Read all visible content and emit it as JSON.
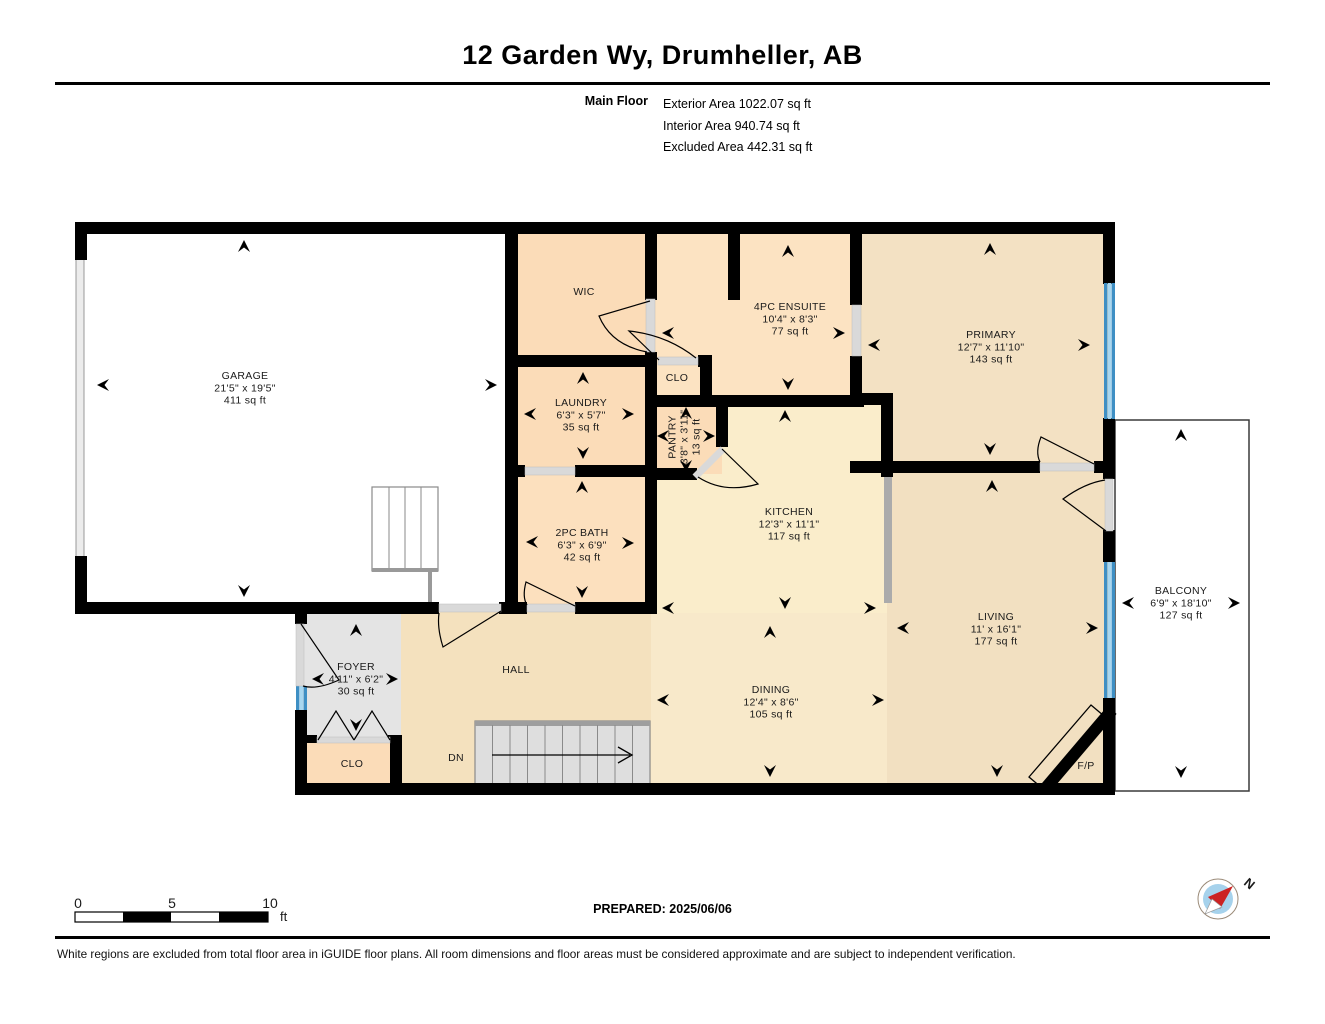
{
  "header": {
    "title": "12 Garden Wy, Drumheller, AB",
    "floor_label": "Main Floor",
    "stats": [
      "Exterior Area 1022.07 sq ft",
      "Interior Area 940.74 sq ft",
      "Excluded Area 442.31 sq ft"
    ]
  },
  "footer": {
    "prepared": "PREPARED: 2025/06/06",
    "disclaimer": "White regions are excluded from total floor area in iGUIDE floor plans. All room dimensions and floor areas must be considered approximate and are subject to independent verification."
  },
  "plan": {
    "colors": {
      "wall": "#000000",
      "sill": "#D9D9D9",
      "counter": "#ABABAB",
      "window_dark": "#3E8FC4",
      "window_light": "#A8D7F0",
      "stair_fill": "#DEDEDE",
      "stair_edge": "#8a8a8a",
      "label": "#1A1A1A"
    },
    "fills": [
      {
        "name": "garage",
        "rect": [
          81,
          228,
          430,
          380
        ],
        "color": "#FFFFFF"
      },
      {
        "name": "ensuite-area",
        "rect": [
          651,
          228,
          205,
          173
        ],
        "color": "#FCE3C2"
      },
      {
        "name": "primary",
        "rect": [
          856,
          228,
          253,
          239
        ],
        "color": "#F3E1C3"
      },
      {
        "name": "kitchen",
        "rect": [
          651,
          401,
          236,
          212
        ],
        "color": "#FAEDCB"
      },
      {
        "name": "dining",
        "rect": [
          651,
          613,
          239,
          176
        ],
        "color": "#F8E9CA"
      },
      {
        "name": "living",
        "rect": [
          887,
          467,
          222,
          322
        ],
        "color": "#F2E0C1"
      },
      {
        "name": "hall",
        "rect": [
          401,
          608,
          250,
          181
        ],
        "color": "#F4E1BE"
      },
      {
        "name": "foyer",
        "rect": [
          301,
          608,
          100,
          181
        ],
        "color": "#E4E4E4"
      },
      {
        "name": "wic",
        "rect": [
          511,
          228,
          140,
          133
        ],
        "color": "#FBDCB8"
      },
      {
        "name": "laundry",
        "rect": [
          511,
          361,
          140,
          110
        ],
        "color": "#FBDCB8"
      },
      {
        "name": "pantry",
        "rect": [
          651,
          401,
          71,
          73
        ],
        "color": "#FBDCB8"
      },
      {
        "name": "bath",
        "rect": [
          511,
          471,
          140,
          137
        ],
        "color": "#FCE0BE"
      },
      {
        "name": "clo-lower",
        "rect": [
          305,
          737,
          88,
          52
        ],
        "color": "#FBDCB8"
      }
    ],
    "balcony_rect": [
      1115,
      420,
      134,
      371
    ],
    "walls": [
      [
        75,
        222,
        1040,
        12
      ],
      [
        75,
        222,
        12,
        38
      ],
      [
        75,
        556,
        12,
        58
      ],
      [
        75,
        602,
        364,
        12
      ],
      [
        499,
        602,
        28,
        12
      ],
      [
        575,
        602,
        82,
        12
      ],
      [
        505,
        222,
        13,
        392
      ],
      [
        645,
        222,
        12,
        78
      ],
      [
        645,
        352,
        12,
        262
      ],
      [
        505,
        355,
        152,
        12
      ],
      [
        698,
        355,
        14,
        12
      ],
      [
        700,
        355,
        12,
        52
      ],
      [
        728,
        222,
        12,
        78
      ],
      [
        645,
        395,
        219,
        12
      ],
      [
        505,
        465,
        20,
        12
      ],
      [
        575,
        465,
        82,
        12
      ],
      [
        716,
        395,
        12,
        52
      ],
      [
        645,
        468,
        52,
        12
      ],
      [
        850,
        222,
        12,
        83
      ],
      [
        850,
        356,
        12,
        49
      ],
      [
        850,
        393,
        43,
        12
      ],
      [
        881,
        393,
        12,
        84
      ],
      [
        850,
        461,
        190,
        12
      ],
      [
        1094,
        461,
        21,
        12
      ],
      [
        1103,
        222,
        12,
        62
      ],
      [
        1103,
        418,
        12,
        61
      ],
      [
        1103,
        530,
        12,
        32
      ],
      [
        1103,
        698,
        12,
        97
      ],
      [
        295,
        602,
        12,
        22
      ],
      [
        295,
        710,
        12,
        85
      ],
      [
        295,
        783,
        820,
        12
      ],
      [
        307,
        735,
        10,
        8
      ],
      [
        388,
        735,
        14,
        8
      ],
      [
        390,
        735,
        12,
        60
      ]
    ],
    "garage_door": [
      76,
      258,
      8,
      300
    ],
    "counter": [
      884,
      477,
      8,
      126
    ],
    "windows": [
      {
        "name": "primary-window",
        "x": 1104,
        "y": 283,
        "len": 136
      },
      {
        "name": "living-window",
        "x": 1104,
        "y": 562,
        "len": 136
      },
      {
        "name": "foyer-window",
        "x": 296,
        "y": 686,
        "len": 24
      }
    ],
    "sills": [
      [
        439,
        604,
        62,
        8
      ],
      [
        527,
        604,
        48,
        8
      ],
      [
        525,
        467,
        50,
        8
      ],
      [
        646,
        299,
        9,
        53
      ],
      [
        658,
        357,
        40,
        8
      ],
      [
        852,
        305,
        9,
        51
      ],
      [
        1040,
        463,
        54,
        8
      ],
      [
        1105,
        479,
        8,
        52
      ],
      [
        317,
        737,
        73,
        6
      ],
      [
        296,
        624,
        8,
        62
      ]
    ],
    "diag_sill": [
      695,
      477,
      723,
      449
    ],
    "doors": [
      "M301,624 L339,680 Q317,690 303,686",
      "M501,611 L443,647 Q437,628 439,613",
      "M575,606 L526,582 Q522,597 527,605",
      "M650,301 L599,316 Q611,345 647,352",
      "M659,360 L629,331 Q667,335 696,358",
      "M722,449 L758,484 Q724,494 698,477",
      "M1094,464 L1041,437 Q1035,452 1040,462",
      "M1106,531 L1063,499 Q1085,483 1105,480"
    ],
    "bifolds": [
      [
        [
          318,
          740
        ],
        [
          336,
          711
        ],
        [
          354,
          740
        ]
      ],
      [
        [
          354,
          740
        ],
        [
          372,
          711
        ],
        [
          390,
          740
        ]
      ]
    ],
    "stairs_dn": {
      "rect": [
        475,
        721,
        175,
        64
      ],
      "treads": 9,
      "arrow_y": 755
    },
    "garage_stairs": {
      "rect": [
        372,
        487,
        66,
        84
      ],
      "treads": [
        389,
        405,
        421
      ],
      "rail_y": 570,
      "rail_x": 430,
      "rail_y2": 602
    },
    "fireplace": {
      "band": [
        1044,
        790,
        1112,
        710
      ],
      "outline": [
        [
          1029,
          777
        ],
        [
          1091,
          705
        ],
        [
          1104,
          716
        ],
        [
          1042,
          788
        ]
      ]
    },
    "arrows": [
      [
        244,
        240,
        "up"
      ],
      [
        244,
        597,
        "down"
      ],
      [
        97,
        385,
        "left"
      ],
      [
        497,
        385,
        "right"
      ],
      [
        583,
        372,
        "up"
      ],
      [
        583,
        459,
        "down"
      ],
      [
        524,
        414,
        "left"
      ],
      [
        634,
        414,
        "right"
      ],
      [
        788,
        245,
        "up"
      ],
      [
        788,
        390,
        "down"
      ],
      [
        662,
        333,
        "left"
      ],
      [
        845,
        333,
        "right"
      ],
      [
        990,
        243,
        "up"
      ],
      [
        990,
        455,
        "down"
      ],
      [
        868,
        345,
        "left"
      ],
      [
        1090,
        345,
        "right"
      ],
      [
        686,
        407,
        "up"
      ],
      [
        686,
        472,
        "down"
      ],
      [
        657,
        436,
        "left"
      ],
      [
        715,
        436,
        "right"
      ],
      [
        785,
        410,
        "up"
      ],
      [
        785,
        609,
        "down"
      ],
      [
        662,
        608,
        "left"
      ],
      [
        876,
        608,
        "right"
      ],
      [
        582,
        481,
        "up"
      ],
      [
        582,
        598,
        "down"
      ],
      [
        526,
        542,
        "left"
      ],
      [
        634,
        543,
        "right"
      ],
      [
        356,
        624,
        "up"
      ],
      [
        356,
        731,
        "down"
      ],
      [
        312,
        679,
        "left"
      ],
      [
        398,
        679,
        "right"
      ],
      [
        770,
        626,
        "up"
      ],
      [
        770,
        777,
        "down"
      ],
      [
        657,
        700,
        "left"
      ],
      [
        884,
        700,
        "right"
      ],
      [
        992,
        480,
        "up"
      ],
      [
        997,
        777,
        "down"
      ],
      [
        897,
        628,
        "left"
      ],
      [
        1098,
        628,
        "right"
      ],
      [
        1181,
        429,
        "up"
      ],
      [
        1181,
        778,
        "down"
      ],
      [
        1122,
        603,
        "left"
      ],
      [
        1240,
        603,
        "right"
      ]
    ],
    "labels": [
      {
        "name": "garage",
        "lines": [
          "GARAGE",
          "21'5\" x 19'5\"",
          "411 sq ft"
        ],
        "x": 245,
        "y": 379
      },
      {
        "name": "wic",
        "lines": [
          "WIC"
        ],
        "x": 584,
        "y": 295
      },
      {
        "name": "ensuite",
        "lines": [
          "4PC ENSUITE",
          "10'4\" x 8'3\"",
          "77 sq ft"
        ],
        "x": 790,
        "y": 310
      },
      {
        "name": "primary",
        "lines": [
          "PRIMARY",
          "12'7\" x 11'10\"",
          "143 sq ft"
        ],
        "x": 991,
        "y": 338
      },
      {
        "name": "clo-upper",
        "lines": [
          "CLO"
        ],
        "x": 677,
        "y": 381
      },
      {
        "name": "laundry",
        "lines": [
          "LAUNDRY",
          "6'3\" x 5'7\"",
          "35 sq ft"
        ],
        "x": 581,
        "y": 406
      },
      {
        "name": "pantry",
        "lines": [
          "PANTRY",
          "3'8\" x 3'11\"",
          "13 sq ft"
        ],
        "x": 687,
        "y": 437,
        "rotate": true
      },
      {
        "name": "kitchen",
        "lines": [
          "KITCHEN",
          "12'3\" x 11'1\"",
          "117 sq ft"
        ],
        "x": 789,
        "y": 515
      },
      {
        "name": "bath",
        "lines": [
          "2PC BATH",
          "6'3\" x 6'9\"",
          "42 sq ft"
        ],
        "x": 582,
        "y": 536
      },
      {
        "name": "foyer",
        "lines": [
          "FOYER",
          "4'11\" x 6'2\"",
          "30 sq ft"
        ],
        "x": 356,
        "y": 670
      },
      {
        "name": "hall",
        "lines": [
          "HALL"
        ],
        "x": 516,
        "y": 673
      },
      {
        "name": "clo-lower",
        "lines": [
          "CLO"
        ],
        "x": 352,
        "y": 767
      },
      {
        "name": "dn",
        "lines": [
          "DN"
        ],
        "x": 456,
        "y": 761
      },
      {
        "name": "dining",
        "lines": [
          "DINING",
          "12'4\" x 8'6\"",
          "105 sq ft"
        ],
        "x": 771,
        "y": 693
      },
      {
        "name": "living",
        "lines": [
          "LIVING",
          "11' x 16'1\"",
          "177 sq ft"
        ],
        "x": 996,
        "y": 620
      },
      {
        "name": "balcony",
        "lines": [
          "BALCONY",
          "6'9\" x 18'10\"",
          "127 sq ft"
        ],
        "x": 1181,
        "y": 594
      },
      {
        "name": "fireplace",
        "lines": [
          "F/P"
        ],
        "x": 1086,
        "y": 769
      }
    ],
    "scalebar": {
      "x": 75,
      "y": 912,
      "w": 193,
      "h": 10,
      "ticks": [
        "0",
        "5",
        "10"
      ],
      "tick_x": [
        78,
        172,
        270
      ],
      "tick_y": 908,
      "unit": "ft",
      "black_segs": [
        [
          123,
          48
        ],
        [
          219,
          49
        ]
      ]
    },
    "compass": {
      "cx": 1218,
      "cy": 899,
      "r": 20,
      "inner_r": 15,
      "label": "N",
      "red": "#CC2222",
      "blue": "#A6D2EC"
    }
  }
}
